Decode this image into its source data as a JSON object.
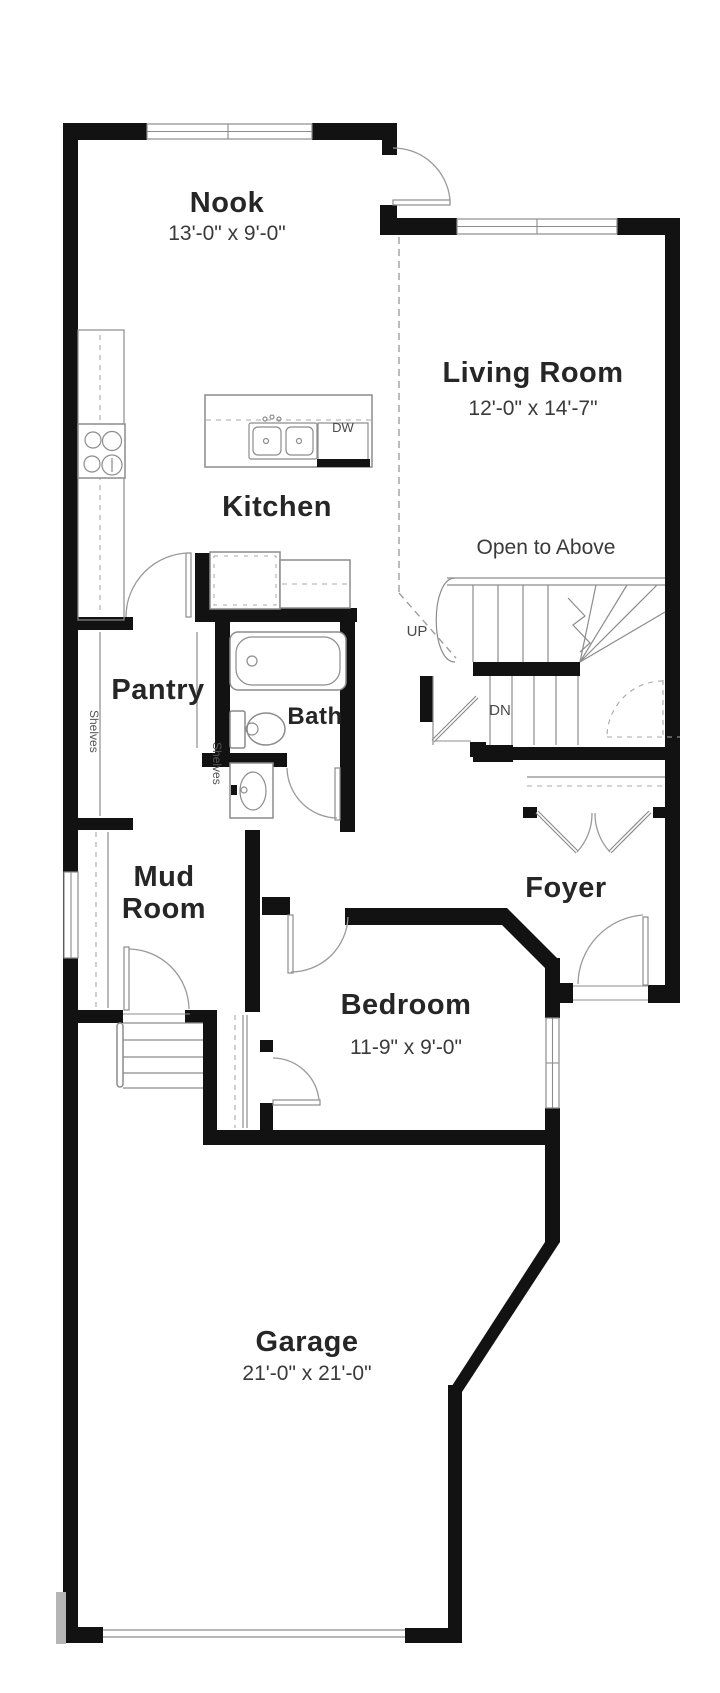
{
  "colors": {
    "wall": "#121212",
    "fixture_line": "#8c8c8c",
    "dashed_line": "#9e9e9e",
    "label_text": "#262626",
    "dimension_text": "#3a3a3a",
    "background": "#ffffff"
  },
  "rooms": {
    "nook": {
      "label": "Nook",
      "dims": "13'-0\" x 9'-0\""
    },
    "living_room": {
      "label": "Living Room",
      "dims": "12'-0\" x 14'-7\""
    },
    "kitchen": {
      "label": "Kitchen"
    },
    "pantry": {
      "label": "Pantry"
    },
    "bath": {
      "label": "Bath"
    },
    "mud_room": {
      "label_line1": "Mud",
      "label_line2": "Room"
    },
    "foyer": {
      "label": "Foyer"
    },
    "bedroom": {
      "label": "Bedroom",
      "dims": "11-9\" x 9'-0\""
    },
    "garage": {
      "label": "Garage",
      "dims": "21'-0\" x 21'-0\""
    }
  },
  "annotations": {
    "open_to_above": "Open to Above",
    "up": "UP",
    "dn": "DN",
    "dishwasher": "DW",
    "shelves_left": "Shelves",
    "shelves_right": "Shelves"
  }
}
